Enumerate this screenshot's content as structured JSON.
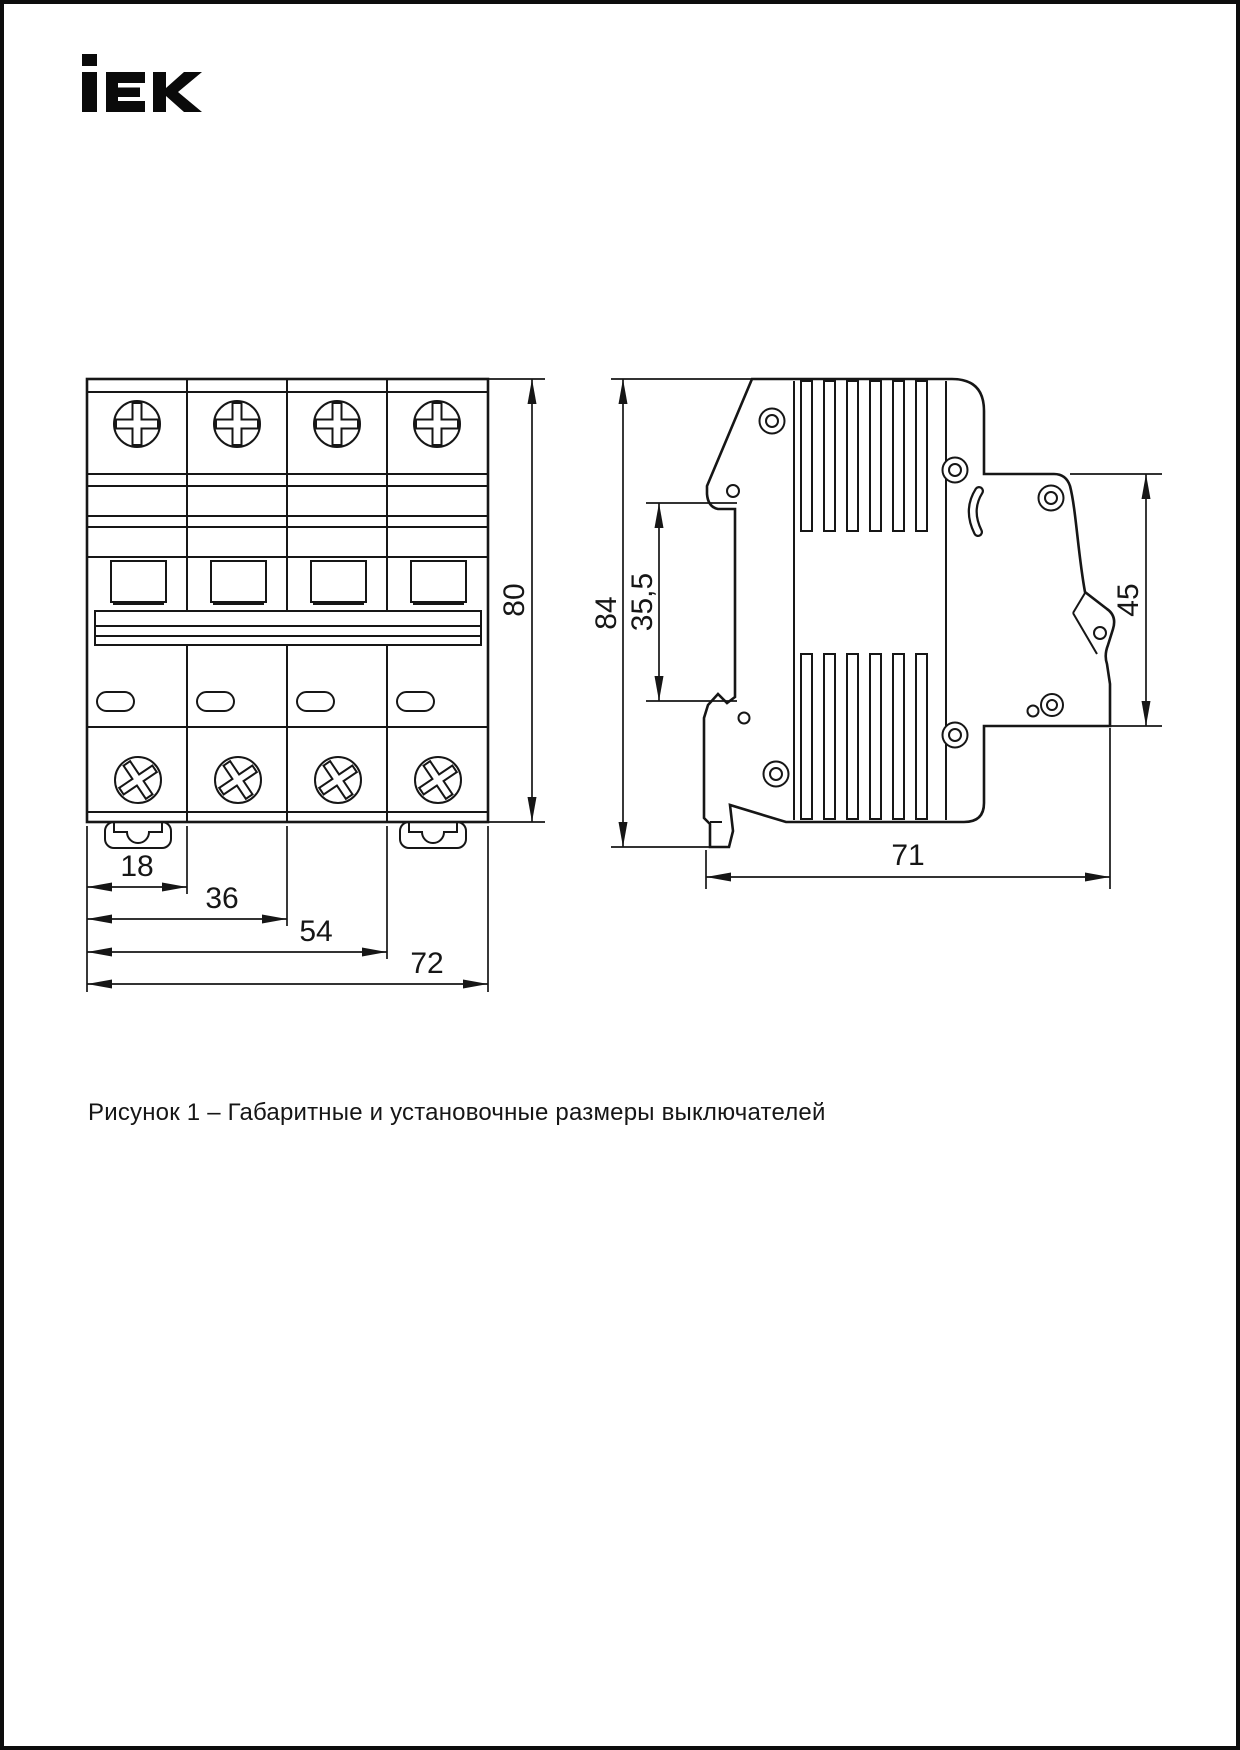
{
  "logo": {
    "text": "iEK"
  },
  "caption": "Рисунок 1 – Габаритные и установочные размеры выключателей",
  "figure": {
    "front_view": {
      "dim_18": "18",
      "dim_36": "36",
      "dim_54": "54",
      "dim_72": "72",
      "dim_80": "80"
    },
    "side_view": {
      "dim_84": "84",
      "dim_35_5": "35,5",
      "dim_45": "45",
      "dim_71": "71"
    }
  }
}
